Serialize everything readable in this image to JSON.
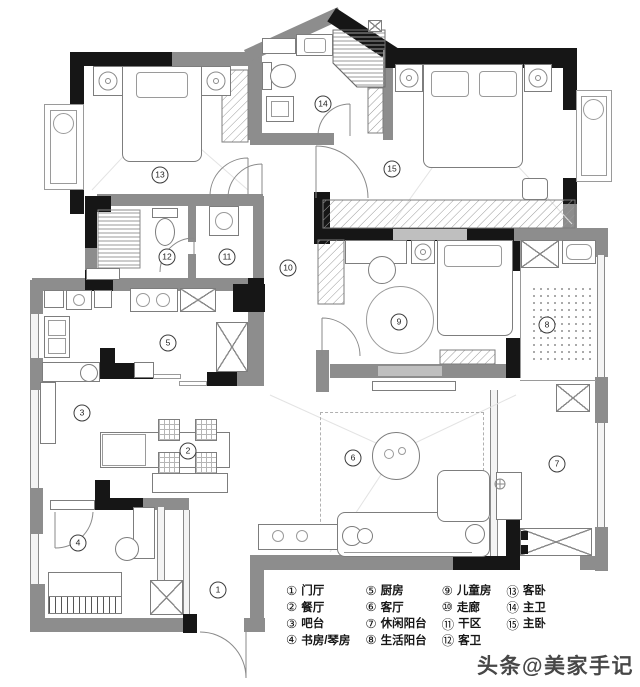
{
  "watermark": "头条@美家手记",
  "legend": {
    "items": [
      {
        "num": "①",
        "label": "门厅"
      },
      {
        "num": "②",
        "label": "餐厅"
      },
      {
        "num": "③",
        "label": "吧台"
      },
      {
        "num": "④",
        "label": "书房/琴房"
      },
      {
        "num": "⑤",
        "label": "厨房"
      },
      {
        "num": "⑥",
        "label": "客厅"
      },
      {
        "num": "⑦",
        "label": "休闲阳台"
      },
      {
        "num": "⑧",
        "label": "生活阳台"
      },
      {
        "num": "⑨",
        "label": "儿童房"
      },
      {
        "num": "⑩",
        "label": "走廊"
      },
      {
        "num": "⑪",
        "label": "干区"
      },
      {
        "num": "⑫",
        "label": "客卫"
      },
      {
        "num": "⑬",
        "label": "客卧"
      },
      {
        "num": "⑭",
        "label": "主卫"
      },
      {
        "num": "⑮",
        "label": "主卧"
      }
    ]
  },
  "plan_markers": [
    {
      "num": "1",
      "x": 218,
      "y": 590
    },
    {
      "num": "2",
      "x": 188,
      "y": 451
    },
    {
      "num": "3",
      "x": 82,
      "y": 413
    },
    {
      "num": "4",
      "x": 78,
      "y": 543
    },
    {
      "num": "5",
      "x": 168,
      "y": 343
    },
    {
      "num": "6",
      "x": 353,
      "y": 458
    },
    {
      "num": "7",
      "x": 557,
      "y": 464
    },
    {
      "num": "8",
      "x": 547,
      "y": 325
    },
    {
      "num": "9",
      "x": 399,
      "y": 322
    },
    {
      "num": "10",
      "x": 288,
      "y": 268
    },
    {
      "num": "11",
      "x": 227,
      "y": 257
    },
    {
      "num": "12",
      "x": 167,
      "y": 257
    },
    {
      "num": "13",
      "x": 160,
      "y": 175
    },
    {
      "num": "14",
      "x": 323,
      "y": 104
    },
    {
      "num": "15",
      "x": 392,
      "y": 169
    }
  ],
  "colors": {
    "wall_gray": "#8d8d8d",
    "wall_black": "#161616",
    "line": "#8a8a8a",
    "text": "#161616"
  }
}
